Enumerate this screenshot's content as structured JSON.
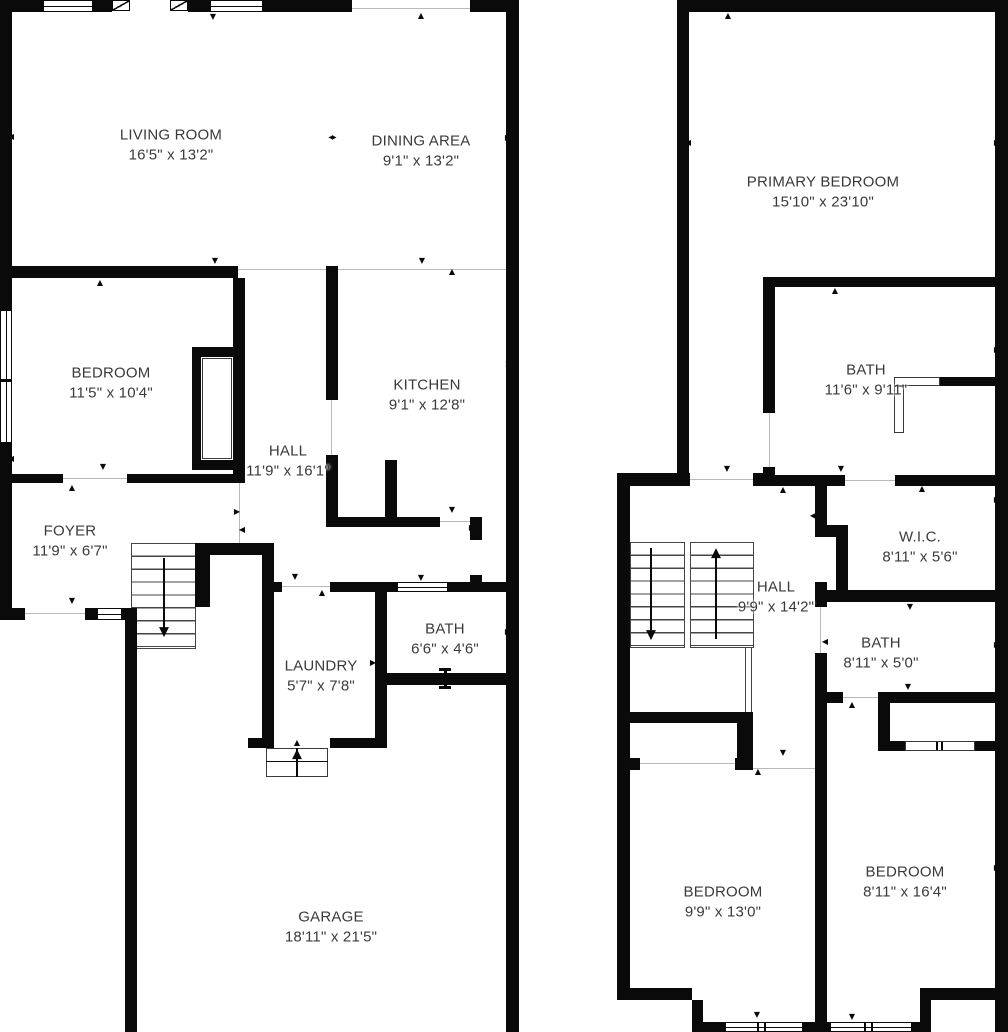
{
  "title": "Two-story house floor plan",
  "floor1": {
    "rooms": [
      {
        "id": "living-room",
        "name": "LIVING ROOM",
        "dims": "16'5\" x 13'2\""
      },
      {
        "id": "dining-area",
        "name": "DINING AREA",
        "dims": "9'1\" x 13'2\""
      },
      {
        "id": "bedroom",
        "name": "BEDROOM",
        "dims": "11'5\" x 10'4\""
      },
      {
        "id": "kitchen",
        "name": "KITCHEN",
        "dims": "9'1\" x 12'8\""
      },
      {
        "id": "hall",
        "name": "HALL",
        "dims": "11'9\" x 16'1\""
      },
      {
        "id": "foyer",
        "name": "FOYER",
        "dims": "11'9\" x 6'7\""
      },
      {
        "id": "laundry",
        "name": "LAUNDRY",
        "dims": "5'7\" x 7'8\""
      },
      {
        "id": "bath",
        "name": "BATH",
        "dims": "6'6\" x 4'6\""
      },
      {
        "id": "garage",
        "name": "GARAGE",
        "dims": "18'11\" x 21'5\""
      }
    ]
  },
  "floor2": {
    "rooms": [
      {
        "id": "primary-bedroom",
        "name": "PRIMARY BEDROOM",
        "dims": "15'10\" x 23'10\""
      },
      {
        "id": "primary-bath",
        "name": "BATH",
        "dims": "11'6\" x 9'11\""
      },
      {
        "id": "wic",
        "name": "W.I.C.",
        "dims": "8'11\" x 5'6\""
      },
      {
        "id": "hall",
        "name": "HALL",
        "dims": "9'9\" x 14'2\""
      },
      {
        "id": "bath",
        "name": "BATH",
        "dims": "8'11\" x 5'0\""
      },
      {
        "id": "bedroom-left",
        "name": "BEDROOM",
        "dims": "9'9\" x 13'0\""
      },
      {
        "id": "bedroom-right",
        "name": "BEDROOM",
        "dims": "8'11\" x 16'4\""
      }
    ]
  },
  "icons": {
    "arrow_up": "▲",
    "arrow_down": "▼",
    "arrow_left": "◀",
    "arrow_right": "▶",
    "opening_span": "◀▶"
  },
  "colors": {
    "wall": "#0a0a0a",
    "background": "#ffffff",
    "label_text": "#3a3a3a"
  }
}
